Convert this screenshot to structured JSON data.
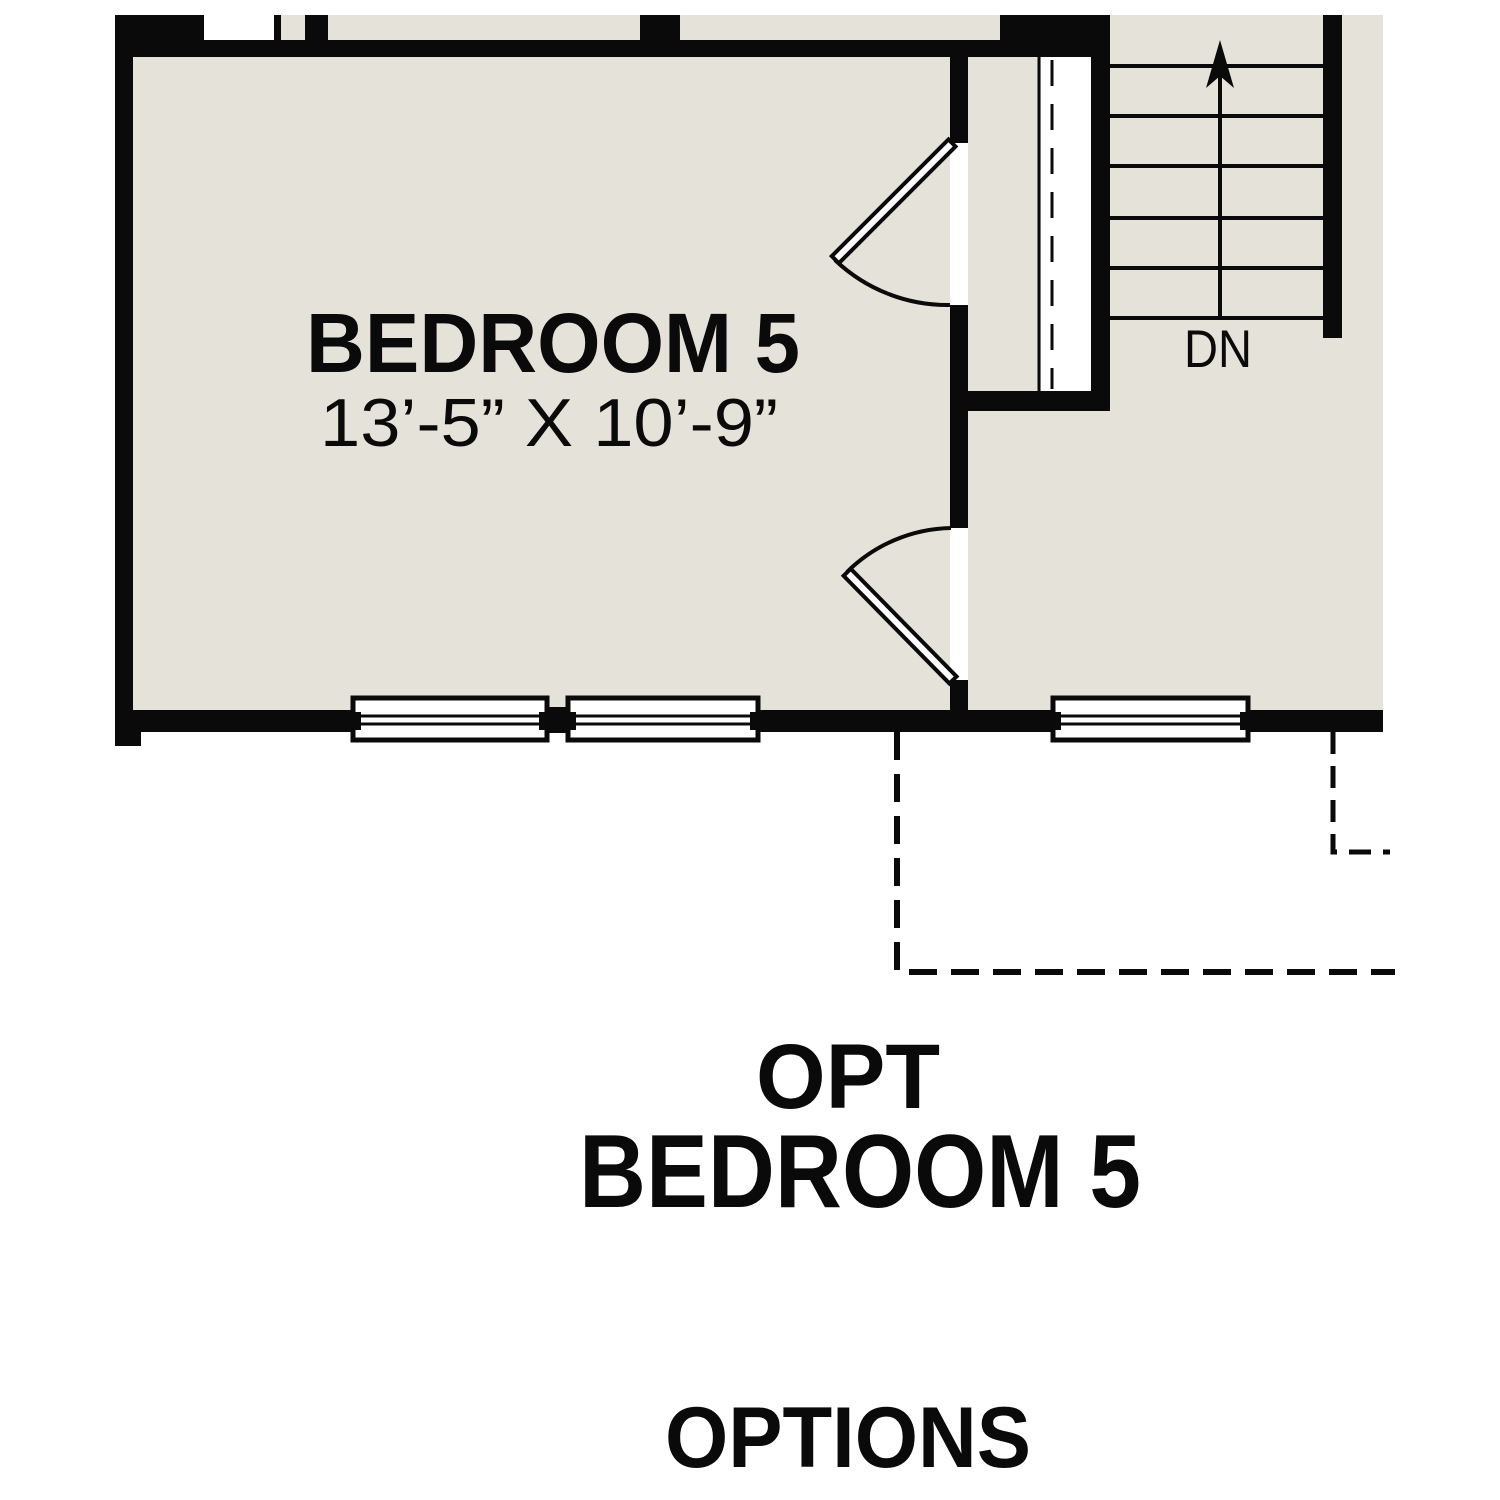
{
  "plan": {
    "colors": {
      "floor": "#e5e2d9",
      "wall": "#0a0a0a",
      "background": "#ffffff"
    },
    "bedroom": {
      "label": "BEDROOM 5",
      "dimensions": "13’-5” X 10’-9”"
    },
    "stairs": {
      "down_label": "DN"
    },
    "caption": {
      "line1": "OPT",
      "line2": "BEDROOM 5"
    },
    "footer": {
      "label": "OPTIONS"
    }
  }
}
